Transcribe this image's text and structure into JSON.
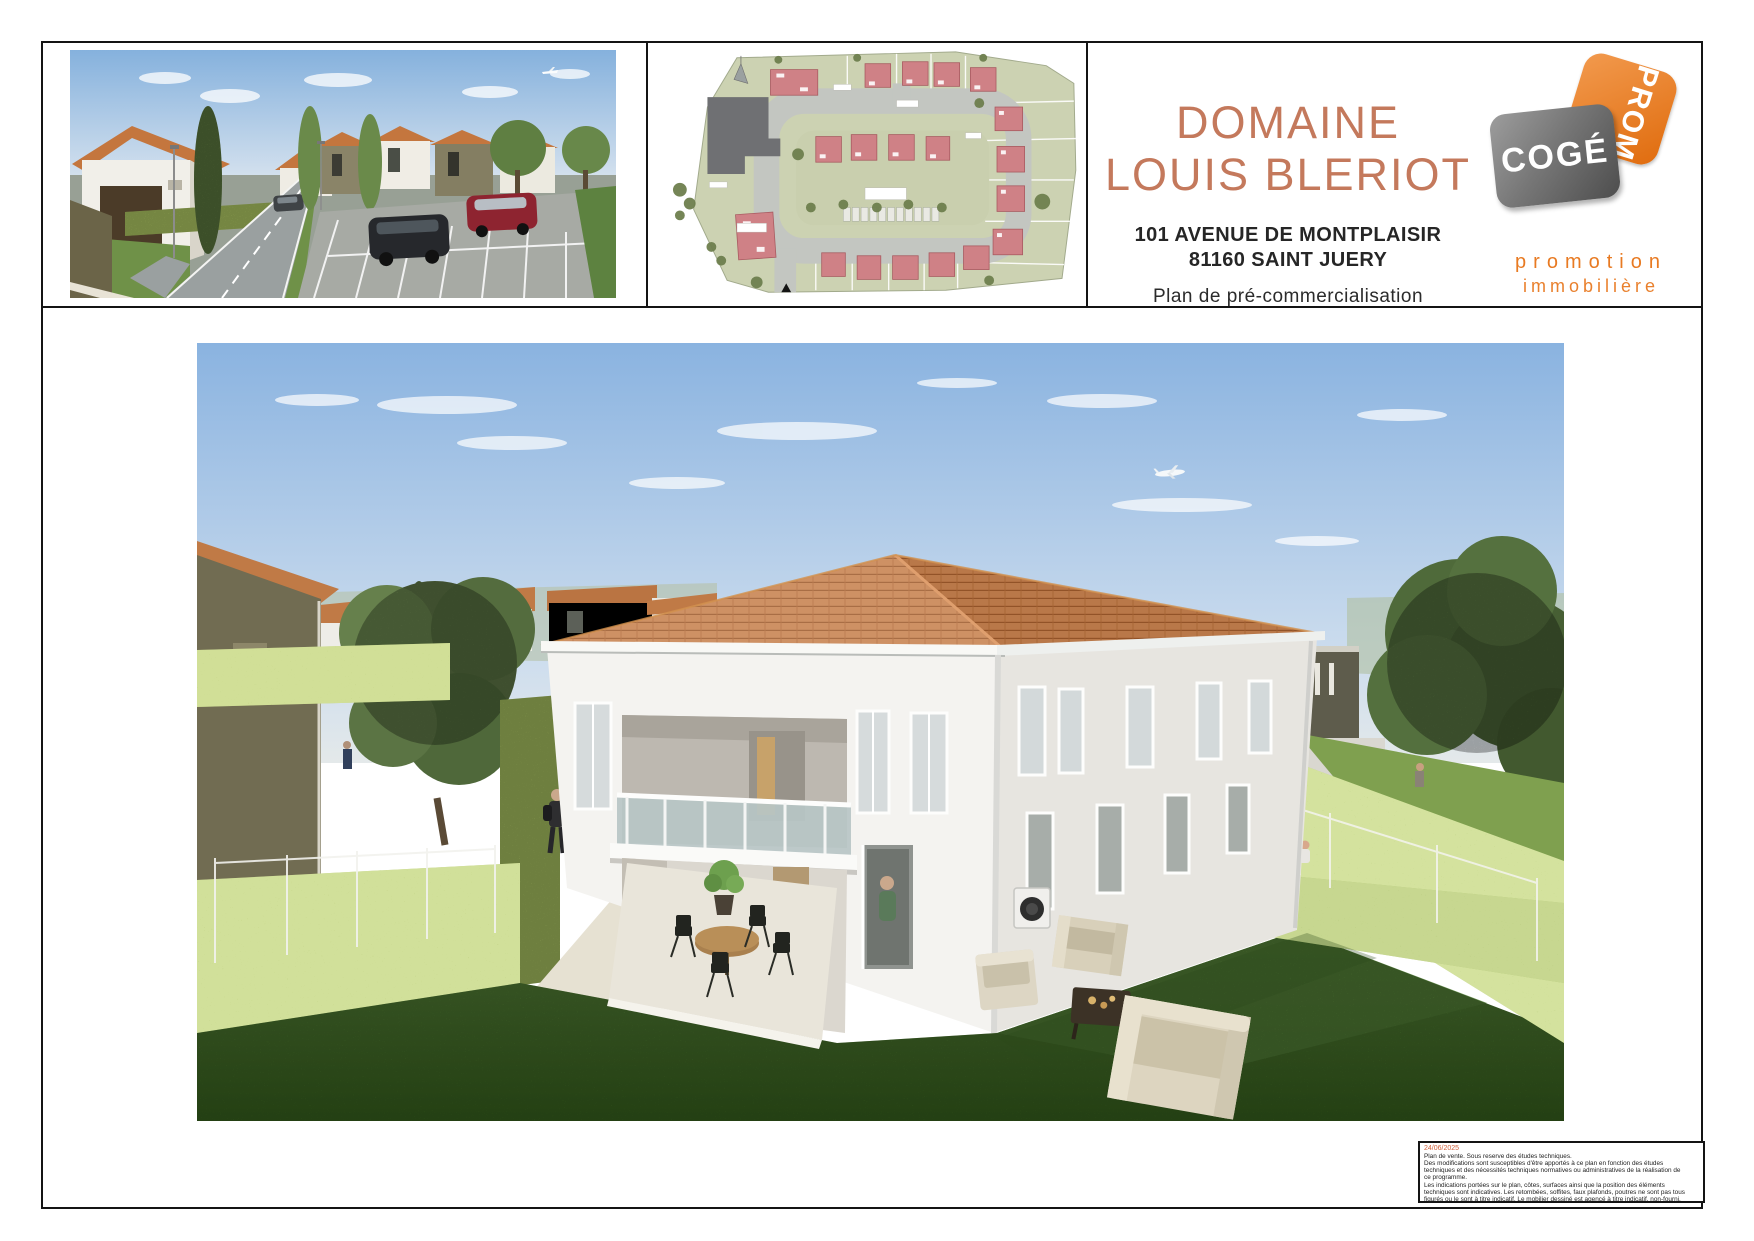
{
  "header": {
    "title_line1": "DOMAINE",
    "title_line2": "LOUIS BLERIOT",
    "address_line1": "101 AVENUE DE MONTPLAISIR",
    "address_line2": "81160 SAINT JUERY",
    "subtitle": "Plan de pré-commercialisation"
  },
  "logo": {
    "brand_top": "COGÉ",
    "brand_side": "PROM",
    "tagline_line1": "promotion",
    "tagline_line2": "immobilière"
  },
  "disclaimer": {
    "date": "24/06/2025",
    "lines": [
      "Plan de vente. Sous reserve des études techniques.",
      "Des modifications sont susceptibles d'être apportés à ce plan en fonction des études",
      "techniques et des nécessités techniques normatives ou administratives de la réalisation de",
      "ce programme.",
      "Les indications portées sur le plan, côtes, surfaces ainsi que la position des éléments",
      "techniques sont indicatives. Les retombées, soffites, faux plafonds, poutres ne sont pas tous",
      "figurés ou le sont à titre indicatif. Le mobilier dessiné est agencé à titre indicatif, non-fourni."
    ]
  },
  "colors": {
    "accent": "#c4795c",
    "logo_orange": "#e87a22",
    "logo_gray": "#6e6e6e",
    "disclaimer_date_color": "#d2603a"
  }
}
